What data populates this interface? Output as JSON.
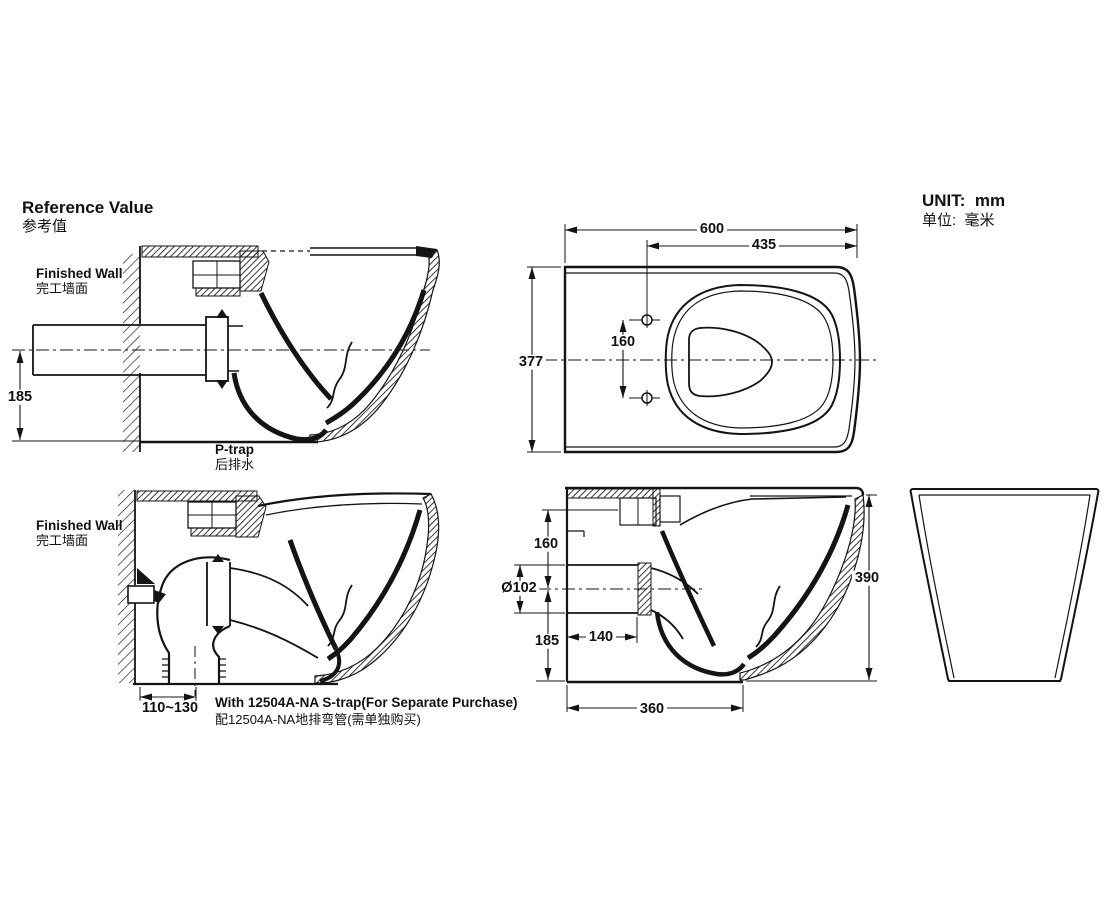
{
  "header": {
    "title_en": "Reference Value",
    "title_zh": "参考值",
    "unit_en": "UNIT:  mm",
    "unit_zh": "单位:  毫米"
  },
  "p_trap_view": {
    "wall_label_en": "Finished Wall",
    "wall_label_zh": "完工墙面",
    "caption_en": "P-trap",
    "caption_zh": "后排水",
    "dim_outlet_center_to_bottom": "185"
  },
  "plan_view": {
    "dim_overall_length": "600",
    "dim_holes_to_front": "435",
    "dim_overall_width": "377",
    "dim_hole_spacing": "160"
  },
  "s_trap_view": {
    "wall_label_en": "Finished Wall",
    "wall_label_zh": "完工墙面",
    "dim_wall_to_floor_outlet": "110~130",
    "caption_en": "With 12504A-NA S-trap(For Separate Purchase)",
    "caption_zh": "配12504A-NA地排弯管(需单独购买)"
  },
  "section_view": {
    "dim_top_to_outlet_center": "160",
    "dim_outlet_diameter": "Ø102",
    "dim_outlet_center_to_floor": "185",
    "dim_wall_to_outlet_end": "140",
    "dim_base_depth": "360",
    "dim_overall_height": "390"
  }
}
